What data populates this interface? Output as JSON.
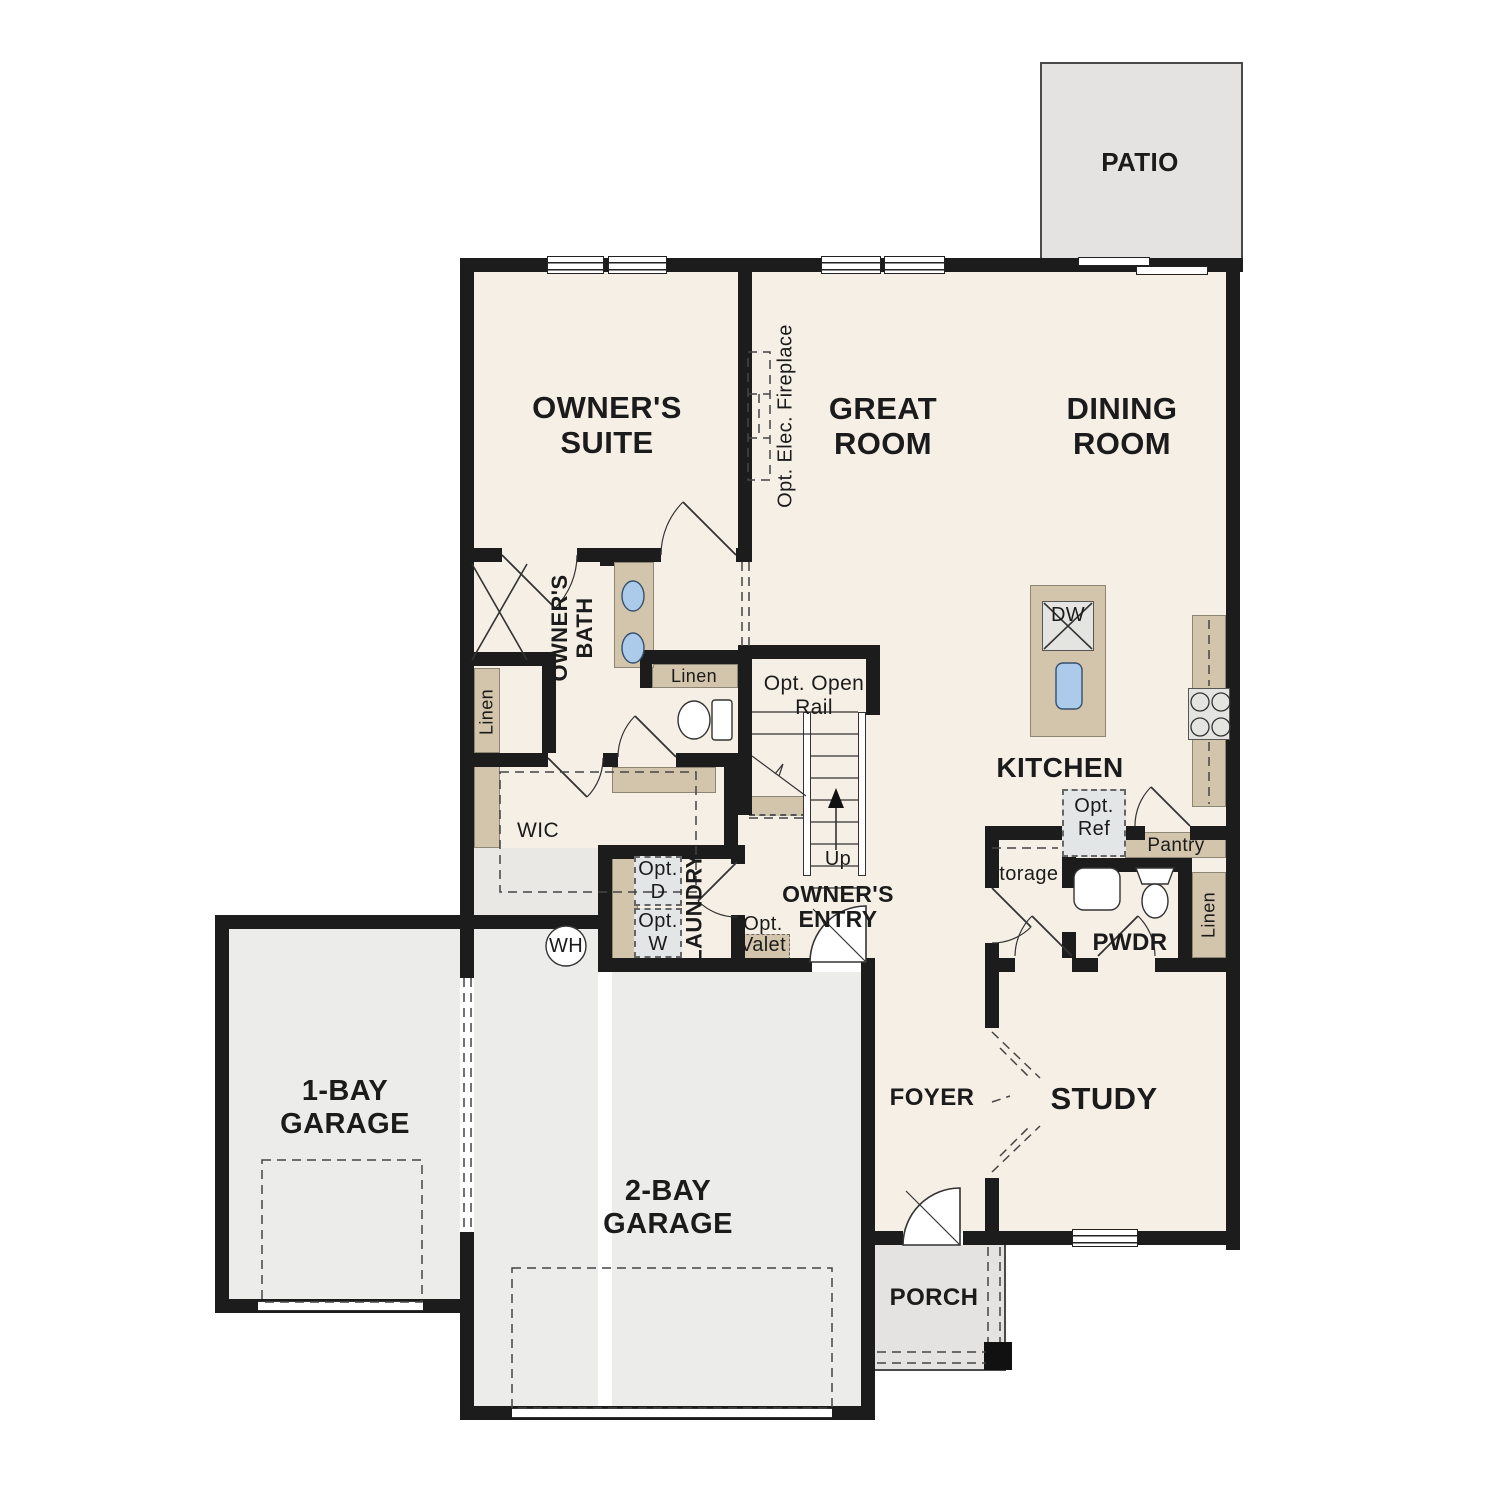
{
  "rooms": {
    "owners_suite": "OWNER'S SUITE",
    "great_room": "GREAT ROOM",
    "dining_room": "DINING ROOM",
    "patio": "PATIO",
    "kitchen": "KITCHEN",
    "foyer": "FOYER",
    "study": "STUDY",
    "porch": "PORCH",
    "garage_1bay": "1-BAY GARAGE",
    "garage_2bay": "2-BAY GARAGE",
    "owners_bath": "OWNER'S BATH",
    "wic": "WIC",
    "laundry": "LAUNDRY",
    "owners_entry": "OWNER'S ENTRY",
    "pwdr": "PWDR",
    "storage": "Storage",
    "pantry": "Pantry"
  },
  "labels": {
    "linen": "Linen",
    "up": "Up",
    "dw": "DW",
    "wh": "WH",
    "opt_elec_fireplace": "Opt. Elec. Fireplace",
    "opt_open_rail": "Opt. Open Rail",
    "opt_ref": "Opt. Ref",
    "opt_d": "Opt. D",
    "opt_w": "Opt. W",
    "opt_valet": "Opt. Valet"
  },
  "colors": {
    "wall": "#1c1c1c",
    "floor": "#f6efe5",
    "outdoor_concrete": "#e4e3e1",
    "garage_floor": "#ececea",
    "cabinetry": "#d2c5ac",
    "plumbing_fixture_blue": "#accbea"
  }
}
